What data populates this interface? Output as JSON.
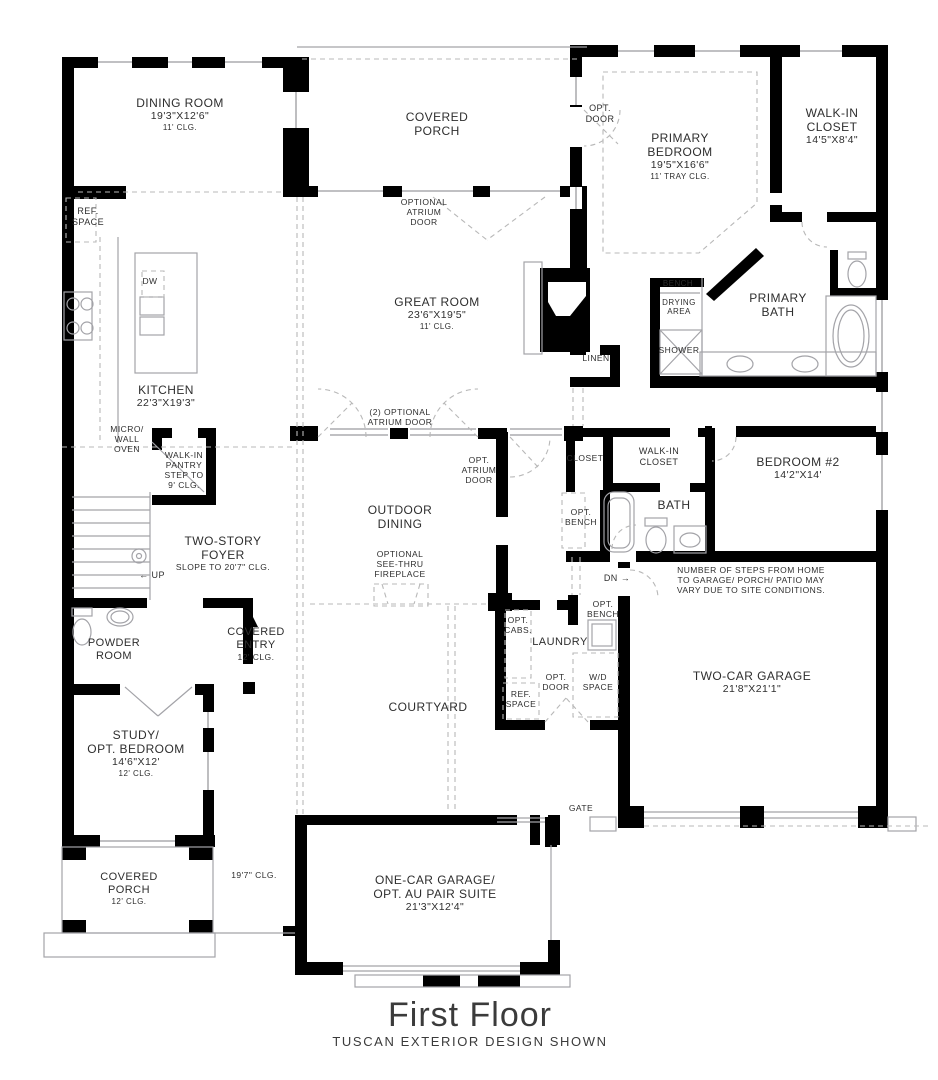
{
  "title": {
    "main": "First Floor",
    "subtitle": "TUSCAN EXTERIOR DESIGN SHOWN"
  },
  "colors": {
    "wall": "#000000",
    "thin_line": "#a3a3a8",
    "dashed_line": "#b8b8b8",
    "text": "#2e2e2e"
  },
  "labels": [
    {
      "name": "dining-room-label",
      "x": 180,
      "y": 96,
      "lines": [
        {
          "t": "DINING ROOM",
          "s": 12
        },
        {
          "t": "19'3\"X12'6\"",
          "s": 10.5
        },
        {
          "t": "11' CLG.",
          "s": 8
        }
      ]
    },
    {
      "name": "ref-space-kitchen-label",
      "x": 88,
      "y": 206,
      "lines": [
        {
          "t": "REF.",
          "s": 9
        },
        {
          "t": "SPACE",
          "s": 9
        }
      ]
    },
    {
      "name": "covered-porch-top-label",
      "x": 437,
      "y": 110,
      "lines": [
        {
          "t": "COVERED",
          "s": 12
        },
        {
          "t": "PORCH",
          "s": 12
        }
      ]
    },
    {
      "name": "optional-atrium-door-label",
      "x": 424,
      "y": 197,
      "lines": [
        {
          "t": "OPTIONAL",
          "s": 8.5
        },
        {
          "t": "ATRIUM",
          "s": 8.5
        },
        {
          "t": "DOOR",
          "s": 8.5
        }
      ]
    },
    {
      "name": "opt-door-primary-label",
      "x": 600,
      "y": 103,
      "lines": [
        {
          "t": "OPT.",
          "s": 9
        },
        {
          "t": "DOOR",
          "s": 9
        }
      ]
    },
    {
      "name": "primary-bedroom-label",
      "x": 680,
      "y": 131,
      "lines": [
        {
          "t": "PRIMARY",
          "s": 12
        },
        {
          "t": "BEDROOM",
          "s": 12
        },
        {
          "t": "19'5\"X16'6\"",
          "s": 10.5
        },
        {
          "t": "11' TRAY CLG.",
          "s": 8
        }
      ]
    },
    {
      "name": "walkin-closet-primary-label",
      "x": 832,
      "y": 106,
      "lines": [
        {
          "t": "WALK-IN",
          "s": 12
        },
        {
          "t": "CLOSET",
          "s": 12
        },
        {
          "t": "14'5\"X8'4\"",
          "s": 10.5
        }
      ]
    },
    {
      "name": "great-room-label",
      "x": 437,
      "y": 295,
      "lines": [
        {
          "t": "GREAT ROOM",
          "s": 12
        },
        {
          "t": "23'6\"X19'5\"",
          "s": 10.5
        },
        {
          "t": "11' CLG.",
          "s": 8
        }
      ]
    },
    {
      "name": "bench-label",
      "x": 678,
      "y": 279,
      "lines": [
        {
          "t": "BENCH",
          "s": 8
        }
      ]
    },
    {
      "name": "drying-area-label",
      "x": 679,
      "y": 298,
      "lines": [
        {
          "t": "DRYING",
          "s": 8
        },
        {
          "t": "AREA",
          "s": 8
        }
      ]
    },
    {
      "name": "primary-bath-label",
      "x": 778,
      "y": 291,
      "lines": [
        {
          "t": "PRIMARY",
          "s": 12
        },
        {
          "t": "BATH",
          "s": 12
        }
      ]
    },
    {
      "name": "shower-label",
      "x": 679,
      "y": 345,
      "lines": [
        {
          "t": "SHOWER",
          "s": 8.5
        }
      ]
    },
    {
      "name": "linen-label",
      "x": 596,
      "y": 353,
      "lines": [
        {
          "t": "LINEN",
          "s": 8.5
        }
      ]
    },
    {
      "name": "kitchen-label",
      "x": 166,
      "y": 383,
      "lines": [
        {
          "t": "KITCHEN",
          "s": 12
        },
        {
          "t": "22'3\"X19'3\"",
          "s": 10.5
        }
      ]
    },
    {
      "name": "dw-label",
      "x": 150,
      "y": 276,
      "lines": [
        {
          "t": "DW",
          "s": 8.5
        }
      ]
    },
    {
      "name": "micro-wall-oven-label",
      "x": 127,
      "y": 424,
      "lines": [
        {
          "t": "MICRO/",
          "s": 8.5
        },
        {
          "t": "WALL",
          "s": 8.5
        },
        {
          "t": "OVEN",
          "s": 8.5
        }
      ]
    },
    {
      "name": "walkin-pantry-label",
      "x": 184,
      "y": 450,
      "lines": [
        {
          "t": "WALK-IN",
          "s": 8.5
        },
        {
          "t": "PANTRY",
          "s": 8.5
        },
        {
          "t": "STEP TO",
          "s": 8.5
        },
        {
          "t": "9' CLG.",
          "s": 8.5
        }
      ]
    },
    {
      "name": "two-optional-atrium-door-label",
      "x": 400,
      "y": 407,
      "lines": [
        {
          "t": "(2) OPTIONAL",
          "s": 8.5
        },
        {
          "t": "ATRIUM DOOR",
          "s": 8.5
        }
      ]
    },
    {
      "name": "opt-atrium-door-label",
      "x": 479,
      "y": 455,
      "lines": [
        {
          "t": "OPT.",
          "s": 8.5
        },
        {
          "t": "ATRIUM",
          "s": 8.5
        },
        {
          "t": "DOOR",
          "s": 8.5
        }
      ]
    },
    {
      "name": "closet-hall-label",
      "x": 585,
      "y": 453,
      "lines": [
        {
          "t": "CLOSET",
          "s": 8.5
        }
      ]
    },
    {
      "name": "walkin-closet-2-label",
      "x": 659,
      "y": 446,
      "lines": [
        {
          "t": "WALK-IN",
          "s": 9
        },
        {
          "t": "CLOSET",
          "s": 9
        }
      ]
    },
    {
      "name": "bedroom-2-label",
      "x": 798,
      "y": 455,
      "lines": [
        {
          "t": "BEDROOM #2",
          "s": 12
        },
        {
          "t": "14'2\"X14'",
          "s": 10.5
        }
      ]
    },
    {
      "name": "opt-bench-hall-label",
      "x": 581,
      "y": 507,
      "lines": [
        {
          "t": "OPT.",
          "s": 8.5
        },
        {
          "t": "BENCH",
          "s": 8.5
        }
      ]
    },
    {
      "name": "bath-2-label",
      "x": 674,
      "y": 498,
      "lines": [
        {
          "t": "BATH",
          "s": 12
        }
      ]
    },
    {
      "name": "dn-label",
      "x": 617,
      "y": 573,
      "lines": [
        {
          "t": "DN →",
          "s": 9
        }
      ]
    },
    {
      "name": "opt-bench-mud-label",
      "x": 603,
      "y": 599,
      "lines": [
        {
          "t": "OPT.",
          "s": 8.5
        },
        {
          "t": "BENCH",
          "s": 8.5
        }
      ]
    },
    {
      "name": "steps-note-label",
      "x": 751,
      "y": 565,
      "lines": [
        {
          "t": "NUMBER OF STEPS FROM HOME",
          "s": 8.5
        },
        {
          "t": "TO GARAGE/ PORCH/ PATIO MAY",
          "s": 8.5
        },
        {
          "t": "VARY DUE TO SITE CONDITIONS.",
          "s": 8.5
        }
      ]
    },
    {
      "name": "two-story-foyer-label",
      "x": 223,
      "y": 534,
      "lines": [
        {
          "t": "TWO-STORY",
          "s": 12
        },
        {
          "t": "FOYER",
          "s": 12
        },
        {
          "t": "SLOPE TO 20'7\" CLG.",
          "s": 8.5
        }
      ]
    },
    {
      "name": "up-label",
      "x": 152,
      "y": 570,
      "lines": [
        {
          "t": "← UP",
          "s": 9
        }
      ]
    },
    {
      "name": "powder-room-label",
      "x": 114,
      "y": 637,
      "lines": [
        {
          "t": "POWDER",
          "s": 11
        },
        {
          "t": "ROOM",
          "s": 11
        }
      ]
    },
    {
      "name": "covered-entry-label",
      "x": 256,
      "y": 626,
      "lines": [
        {
          "t": "COVERED",
          "s": 11
        },
        {
          "t": "ENTRY",
          "s": 11
        },
        {
          "t": "12' CLG.",
          "s": 8.5
        }
      ]
    },
    {
      "name": "outdoor-dining-label",
      "x": 400,
      "y": 503,
      "lines": [
        {
          "t": "OUTDOOR",
          "s": 12
        },
        {
          "t": "DINING",
          "s": 12
        }
      ]
    },
    {
      "name": "see-thru-fireplace-label",
      "x": 400,
      "y": 549,
      "lines": [
        {
          "t": "OPTIONAL",
          "s": 8.5
        },
        {
          "t": "SEE-THRU",
          "s": 8.5
        },
        {
          "t": "FIREPLACE",
          "s": 8.5
        }
      ]
    },
    {
      "name": "opt-cabs-label",
      "x": 518,
      "y": 615,
      "lines": [
        {
          "t": "OPT.",
          "s": 8.5
        },
        {
          "t": "CABS.",
          "s": 8.5
        }
      ]
    },
    {
      "name": "laundry-label",
      "x": 560,
      "y": 636,
      "lines": [
        {
          "t": "LAUNDRY",
          "s": 11
        }
      ]
    },
    {
      "name": "ref-space-laundry-label",
      "x": 521,
      "y": 689,
      "lines": [
        {
          "t": "REF.",
          "s": 8.5
        },
        {
          "t": "SPACE",
          "s": 8.5
        }
      ]
    },
    {
      "name": "opt-door-laundry-label",
      "x": 556,
      "y": 672,
      "lines": [
        {
          "t": "OPT.",
          "s": 8.5
        },
        {
          "t": "DOOR",
          "s": 8.5
        }
      ]
    },
    {
      "name": "wd-space-label",
      "x": 598,
      "y": 672,
      "lines": [
        {
          "t": "W/D",
          "s": 8.5
        },
        {
          "t": "SPACE",
          "s": 8.5
        }
      ]
    },
    {
      "name": "two-car-garage-label",
      "x": 752,
      "y": 669,
      "lines": [
        {
          "t": "TWO-CAR GARAGE",
          "s": 12
        },
        {
          "t": "21'8\"X21'1\"",
          "s": 10.5
        }
      ]
    },
    {
      "name": "gate-label",
      "x": 581,
      "y": 803,
      "lines": [
        {
          "t": "GATE",
          "s": 8.5
        }
      ]
    },
    {
      "name": "study-opt-bedroom-label",
      "x": 136,
      "y": 728,
      "lines": [
        {
          "t": "STUDY/",
          "s": 12
        },
        {
          "t": "OPT. BEDROOM",
          "s": 12
        },
        {
          "t": "14'6\"X12'",
          "s": 10.5
        },
        {
          "t": "12' CLG.",
          "s": 8
        }
      ]
    },
    {
      "name": "covered-porch-bottom-label",
      "x": 129,
      "y": 871,
      "lines": [
        {
          "t": "COVERED",
          "s": 11
        },
        {
          "t": "PORCH",
          "s": 11
        },
        {
          "t": "12' CLG.",
          "s": 8
        }
      ]
    },
    {
      "name": "ceiling-197-label",
      "x": 254,
      "y": 870,
      "lines": [
        {
          "t": "19'7\" CLG.",
          "s": 8.5
        }
      ]
    },
    {
      "name": "one-car-garage-label",
      "x": 435,
      "y": 873,
      "lines": [
        {
          "t": "ONE-CAR GARAGE/",
          "s": 12
        },
        {
          "t": "OPT. AU PAIR SUITE",
          "s": 12
        },
        {
          "t": "21'3\"X12'4\"",
          "s": 10.5
        }
      ]
    },
    {
      "name": "courtyard-label",
      "x": 428,
      "y": 700,
      "lines": [
        {
          "t": "COURTYARD",
          "s": 12
        }
      ]
    }
  ]
}
